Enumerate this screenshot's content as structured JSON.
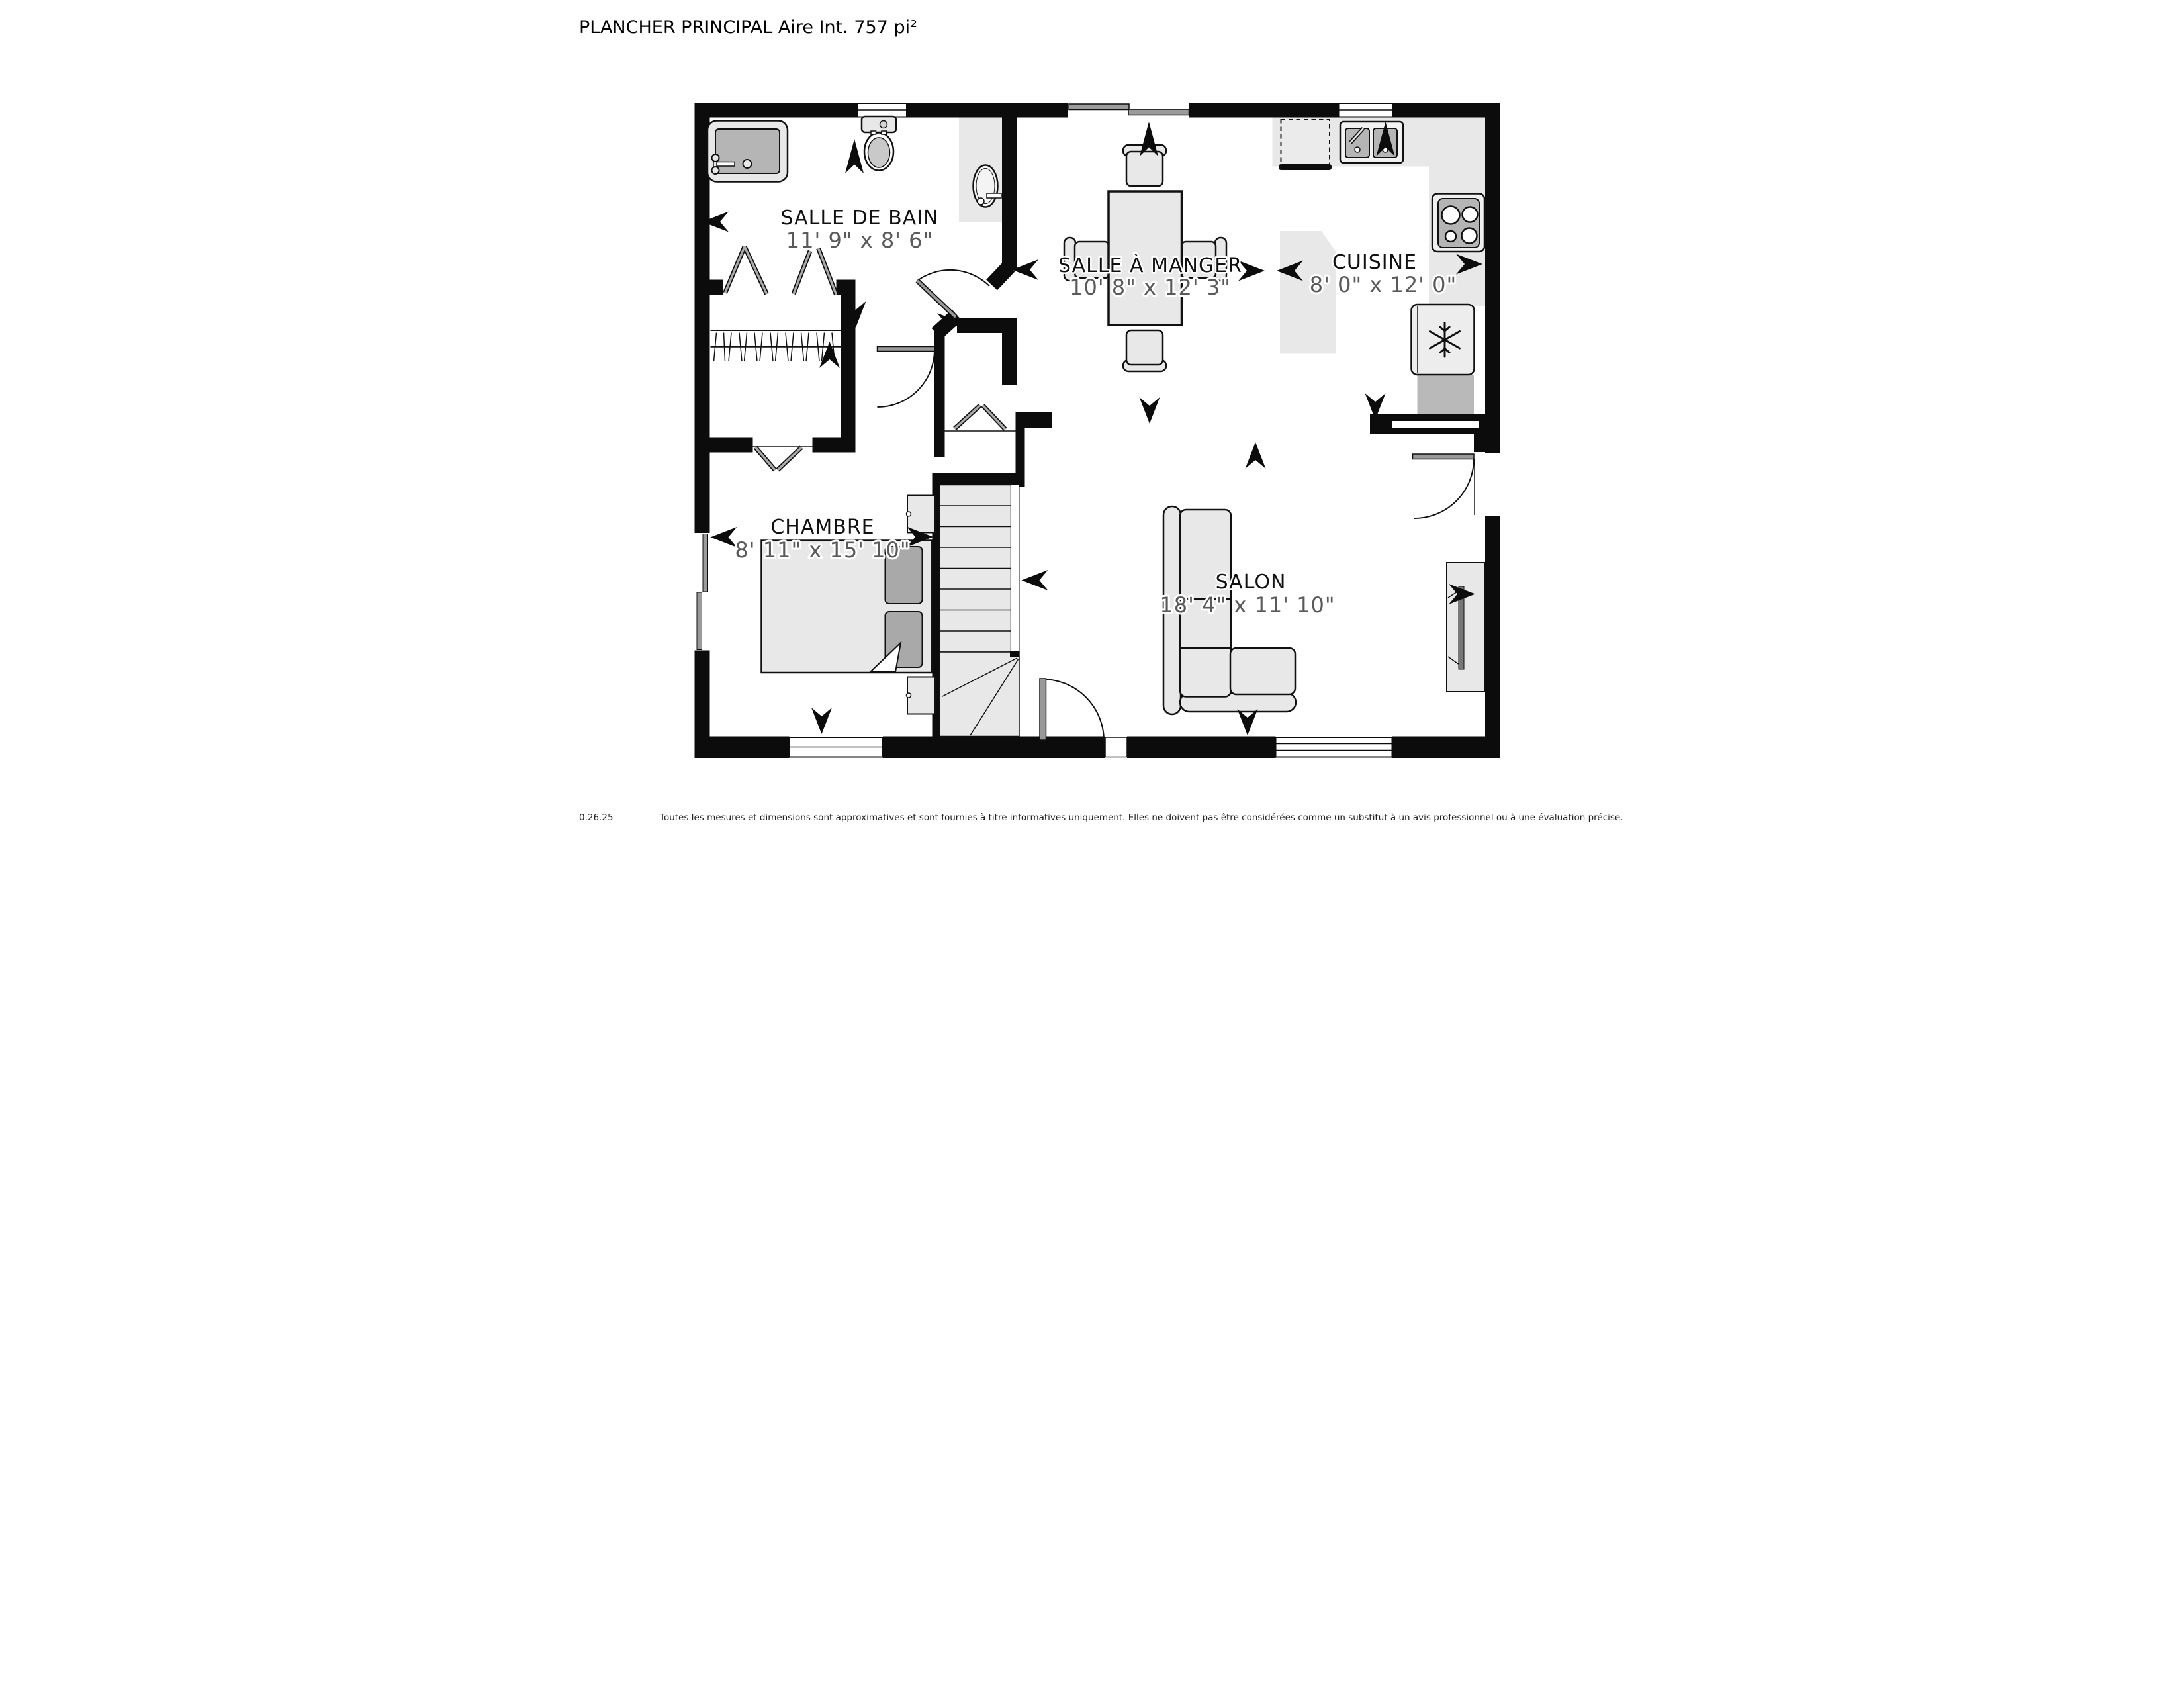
{
  "title": "PLANCHER PRINCIPAL Aire Int. 757 pi²",
  "rooms": {
    "bathroom": {
      "name": "SALLE DE BAIN",
      "dims": "11' 9\" x 8' 6\""
    },
    "dining": {
      "name": "SALLE À MANGER",
      "dims": "10' 8\" x 12' 3\""
    },
    "kitchen": {
      "name": "CUISINE",
      "dims": "8' 0\" x 12' 0\""
    },
    "bedroom": {
      "name": "CHAMBRE",
      "dims": "8' 11\" x 15' 10\""
    },
    "living": {
      "name": "SALON",
      "dims": "18' 4\" x 11' 10\""
    }
  },
  "footer": {
    "version": "0.26.25",
    "disclaimer": "Toutes les mesures et dimensions sont approximatives et sont fournies à titre informatives uniquement. Elles ne doivent pas être considérées comme un substitut à un avis professionnel ou à une évaluation précise."
  },
  "colors": {
    "wall": "#0c0c0c",
    "counter": "#e8e8e8",
    "fixture": "#b5b5b5",
    "dims_text": "#5a5a5a",
    "window_bar": "#9b9b9b"
  }
}
